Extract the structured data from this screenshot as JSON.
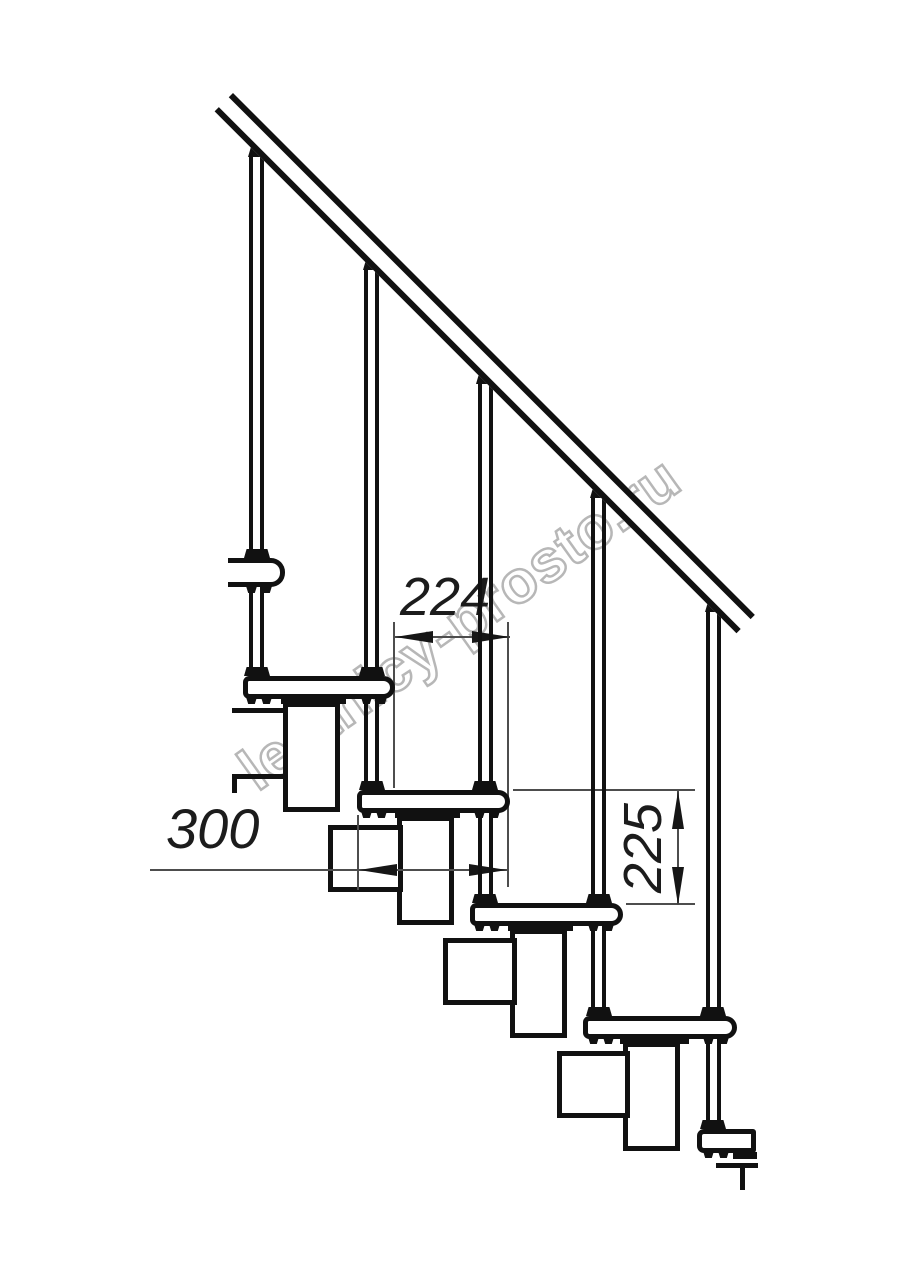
{
  "drawing": {
    "watermark": "lestnicy-prosto.ru",
    "dim_tread_run": "224",
    "dim_tread_depth": "300",
    "dim_riser_height": "225",
    "colors": {
      "line": "#111111",
      "dim_line": "#4d4d4d",
      "dim_text": "#1c1c1c",
      "watermark": "#a6a6a6",
      "background": "#ffffff"
    }
  }
}
